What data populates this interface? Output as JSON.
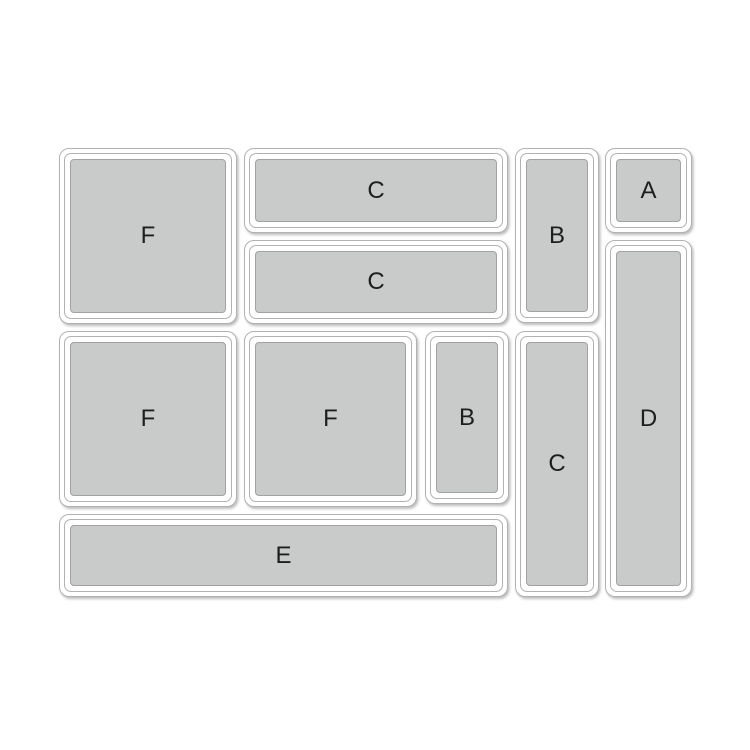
{
  "diagram": {
    "title": "drawer-organizer-layout",
    "background_color": "#ffffff",
    "tray_border_color": "#b2b2b2",
    "pad_fill_color": "#c9caca",
    "pad_border_color": "#a2a2a2",
    "label_color": "#1e1e1e",
    "trays": [
      {
        "id": "F1",
        "label": "F",
        "x": 59,
        "y": 148,
        "w": 178,
        "h": 176
      },
      {
        "id": "C1",
        "label": "C",
        "x": 244,
        "y": 148,
        "w": 264,
        "h": 85
      },
      {
        "id": "B1",
        "label": "B",
        "x": 515,
        "y": 148,
        "w": 84,
        "h": 175
      },
      {
        "id": "A1",
        "label": "A",
        "x": 605,
        "y": 148,
        "w": 87,
        "h": 85
      },
      {
        "id": "C2",
        "label": "C",
        "x": 244,
        "y": 240,
        "w": 264,
        "h": 84
      },
      {
        "id": "D1",
        "label": "D",
        "x": 605,
        "y": 240,
        "w": 87,
        "h": 357
      },
      {
        "id": "F2",
        "label": "F",
        "x": 59,
        "y": 331,
        "w": 178,
        "h": 176
      },
      {
        "id": "F3",
        "label": "F",
        "x": 244,
        "y": 331,
        "w": 173,
        "h": 176
      },
      {
        "id": "B2",
        "label": "B",
        "x": 425,
        "y": 331,
        "w": 84,
        "h": 173
      },
      {
        "id": "C3",
        "label": "C",
        "x": 515,
        "y": 331,
        "w": 84,
        "h": 266
      },
      {
        "id": "E1",
        "label": "E",
        "x": 59,
        "y": 514,
        "w": 449,
        "h": 83
      }
    ]
  }
}
